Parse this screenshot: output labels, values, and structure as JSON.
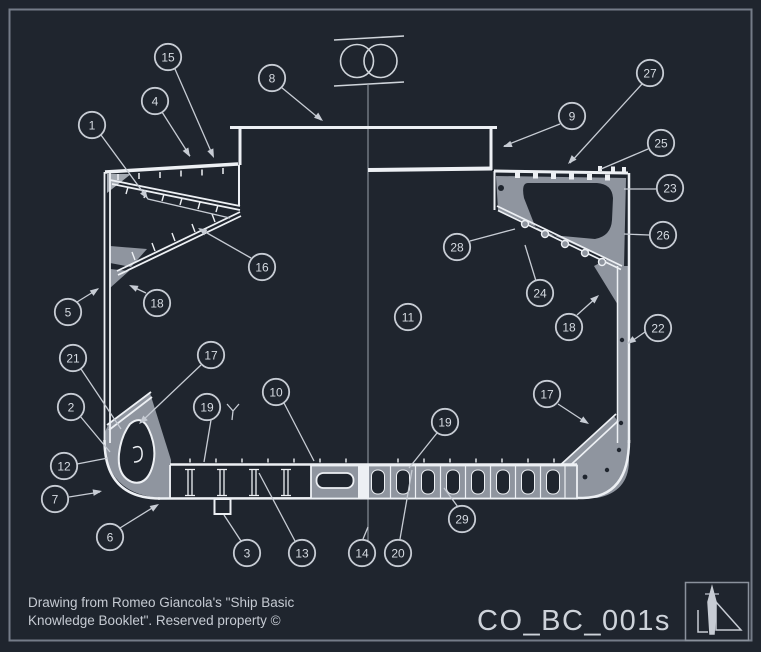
{
  "drawing": {
    "title_block": {
      "credit_line1": "Drawing from Romeo Giancola's \"Ship Basic",
      "credit_line2": "Knowledge Booklet\". Reserved property ©",
      "doc_code": "CO_BC_001s"
    },
    "colors": {
      "background": "#1f252e",
      "line_white": "#edf0f4",
      "plate_gray": "#8f959f",
      "plate_gray_light": "#a4aab2",
      "annotation": "#c7ccd4",
      "frame_border": "#747c88"
    },
    "callouts": [
      {
        "n": "1",
        "x": 92,
        "y": 125
      },
      {
        "n": "2",
        "x": 71,
        "y": 407
      },
      {
        "n": "3",
        "x": 247,
        "y": 553
      },
      {
        "n": "4",
        "x": 155,
        "y": 101
      },
      {
        "n": "5",
        "x": 68,
        "y": 312
      },
      {
        "n": "6",
        "x": 110,
        "y": 537
      },
      {
        "n": "7",
        "x": 55,
        "y": 499
      },
      {
        "n": "8",
        "x": 272,
        "y": 78
      },
      {
        "n": "9",
        "x": 572,
        "y": 116
      },
      {
        "n": "10",
        "x": 276,
        "y": 392
      },
      {
        "n": "11",
        "x": 408,
        "y": 317
      },
      {
        "n": "12",
        "x": 64,
        "y": 466
      },
      {
        "n": "13",
        "x": 302,
        "y": 553
      },
      {
        "n": "14",
        "x": 362,
        "y": 553
      },
      {
        "n": "15",
        "x": 168,
        "y": 57
      },
      {
        "n": "16",
        "x": 262,
        "y": 267
      },
      {
        "n": "17",
        "x": 211,
        "y": 355
      },
      {
        "n": "17",
        "x": 547,
        "y": 394
      },
      {
        "n": "18",
        "x": 157,
        "y": 303
      },
      {
        "n": "18",
        "x": 569,
        "y": 327
      },
      {
        "n": "19",
        "x": 207,
        "y": 407
      },
      {
        "n": "19",
        "x": 445,
        "y": 422
      },
      {
        "n": "20",
        "x": 398,
        "y": 553
      },
      {
        "n": "21",
        "x": 73,
        "y": 358
      },
      {
        "n": "22",
        "x": 658,
        "y": 328
      },
      {
        "n": "23",
        "x": 670,
        "y": 188
      },
      {
        "n": "24",
        "x": 540,
        "y": 293
      },
      {
        "n": "25",
        "x": 661,
        "y": 143
      },
      {
        "n": "26",
        "x": 663,
        "y": 235
      },
      {
        "n": "27",
        "x": 650,
        "y": 73
      },
      {
        "n": "28",
        "x": 457,
        "y": 247
      },
      {
        "n": "29",
        "x": 462,
        "y": 519
      }
    ],
    "leaders": [
      {
        "pts": [
          [
            101,
            135
          ],
          [
            148,
            199
          ],
          [
            230,
            218
          ]
        ]
      },
      {
        "pts": [
          [
            80,
            416
          ],
          [
            110,
            452
          ]
        ]
      },
      {
        "pts": [
          [
            241,
            541
          ],
          [
            224,
            515
          ]
        ]
      },
      {
        "pts": [
          [
            162,
            112
          ],
          [
            190,
            156
          ]
        ]
      },
      {
        "pts": [
          [
            77,
            302
          ],
          [
            98,
            289
          ]
        ]
      },
      {
        "pts": [
          [
            120,
            528
          ],
          [
            157,
            505
          ]
        ]
      },
      {
        "pts": [
          [
            69,
            497
          ],
          [
            100,
            492
          ]
        ]
      },
      {
        "pts": [
          [
            281,
            87
          ],
          [
            321,
            120
          ]
        ]
      },
      {
        "pts": [
          [
            560,
            124
          ],
          [
            504,
            146
          ]
        ]
      },
      {
        "pts": [
          [
            284,
            403
          ],
          [
            314,
            461
          ]
        ]
      },
      {
        "pts": [
          [
            77,
            464
          ],
          [
            108,
            458
          ]
        ]
      },
      {
        "pts": [
          [
            295,
            541
          ],
          [
            259,
            473
          ]
        ]
      },
      {
        "pts": [
          [
            363,
            539
          ],
          [
            368,
            527
          ]
        ]
      },
      {
        "pts": [
          [
            175,
            69
          ],
          [
            213,
            156
          ]
        ]
      },
      {
        "pts": [
          [
            251,
            258
          ],
          [
            200,
            229
          ]
        ]
      },
      {
        "pts": [
          [
            201,
            365
          ],
          [
            141,
            422
          ]
        ]
      },
      {
        "pts": [
          [
            558,
            404
          ],
          [
            587,
            423
          ]
        ]
      },
      {
        "pts": [
          [
            146,
            293
          ],
          [
            131,
            286
          ]
        ]
      },
      {
        "pts": [
          [
            577,
            315
          ],
          [
            597,
            297
          ]
        ]
      },
      {
        "pts": [
          [
            211,
            420
          ],
          [
            204,
            462
          ]
        ]
      },
      {
        "pts": [
          [
            437,
            433
          ],
          [
            409,
            468
          ]
        ]
      },
      {
        "pts": [
          [
            400,
            539
          ],
          [
            412,
            470
          ]
        ]
      },
      {
        "pts": [
          [
            81,
            369
          ],
          [
            121,
            429
          ]
        ]
      },
      {
        "pts": [
          [
            645,
            332
          ],
          [
            629,
            343
          ]
        ]
      },
      {
        "pts": [
          [
            656,
            189
          ],
          [
            624,
            189
          ]
        ]
      },
      {
        "pts": [
          [
            536,
            281
          ],
          [
            525,
            245
          ]
        ]
      },
      {
        "pts": [
          [
            648,
            149
          ],
          [
            601,
            169
          ]
        ]
      },
      {
        "pts": [
          [
            649,
            235
          ],
          [
            624,
            234
          ]
        ]
      },
      {
        "pts": [
          [
            642,
            84
          ],
          [
            570,
            163
          ]
        ]
      },
      {
        "pts": [
          [
            470,
            241
          ],
          [
            515,
            229
          ]
        ]
      },
      {
        "pts": [
          [
            458,
            507
          ],
          [
            444,
            488
          ]
        ]
      }
    ],
    "arrows": [
      {
        "x": 148,
        "y": 199,
        "a": 54
      },
      {
        "x": 190,
        "y": 157,
        "a": 60
      },
      {
        "x": 214,
        "y": 158,
        "a": 66
      },
      {
        "x": 323,
        "y": 121,
        "a": 40
      },
      {
        "x": 99,
        "y": 288,
        "a": 325
      },
      {
        "x": 129,
        "y": 285,
        "a": 205
      },
      {
        "x": 198,
        "y": 228,
        "a": 210
      },
      {
        "x": 503,
        "y": 147,
        "a": 160
      },
      {
        "x": 568,
        "y": 164,
        "a": 133
      },
      {
        "x": 627,
        "y": 344,
        "a": 145
      },
      {
        "x": 599,
        "y": 295,
        "a": 318
      },
      {
        "x": 589,
        "y": 424,
        "a": 33
      },
      {
        "x": 139,
        "y": 424,
        "a": 137
      },
      {
        "x": 102,
        "y": 491,
        "a": 350
      },
      {
        "x": 159,
        "y": 504,
        "a": 328
      }
    ]
  }
}
